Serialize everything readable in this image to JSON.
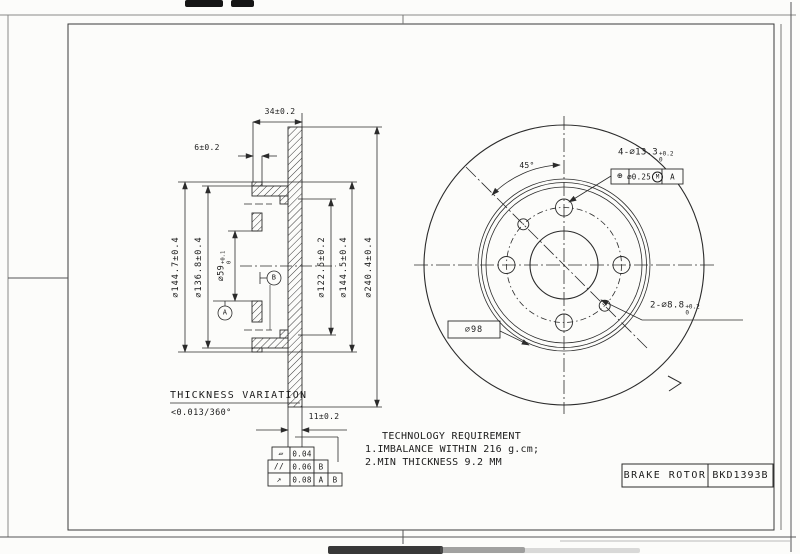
{
  "sheet": {
    "paper_color": "#fcfcfa",
    "ink_color": "#1c1c1c"
  },
  "section_view": {
    "dim_width": "34±0.2",
    "dim_flange": "6±0.2",
    "dim_disc_thickness": "11±0.2",
    "dia_1447": "∅144.7±0.4",
    "dia_1368": "∅136.8±0.4",
    "dia_59": {
      "base": "∅59",
      "sup": "+0.1",
      "sub": "0"
    },
    "dia_1225": "∅122.5±0.2",
    "dia_1445": "∅144.5±0.4",
    "dia_2404": "∅240.4±0.4",
    "datum_a": "A",
    "datum_b": "B",
    "note_line1": "THICKNESS VARIATION",
    "note_line2": "<0.013/360°"
  },
  "tolerance_table": {
    "rows": [
      {
        "symbol": "▱",
        "symbol_name": "flatness",
        "value": "0.04"
      },
      {
        "symbol": "//",
        "symbol_name": "parallelism",
        "value": "0.06",
        "datum1": "B"
      },
      {
        "symbol": "↗",
        "symbol_name": "circular-runout",
        "value": "0.08",
        "datum1": "A",
        "datum2": "B"
      }
    ]
  },
  "tech_requirement": {
    "title": "TECHNOLOGY REQUIREMENT",
    "item1": "1.IMBALANCE WITHIN 216 g.cm;",
    "item2": "2.MIN THICKNESS 9.2 MM"
  },
  "front_view": {
    "angle": "45°",
    "bolt_holes": {
      "base": "4-∅13.3",
      "sup": "+0.2",
      "sub": "0"
    },
    "position_fcf": {
      "symbol": "⊕",
      "tolerance": "∅0.25",
      "modifier": "M",
      "datum": "A"
    },
    "pin_holes": {
      "base": "2-∅8.8",
      "sup": "+0.2",
      "sub": "0"
    },
    "bolt_circle": "∅98"
  },
  "title_block": {
    "part_name": "BRAKE ROTOR",
    "part_number": "BKD1393B"
  }
}
